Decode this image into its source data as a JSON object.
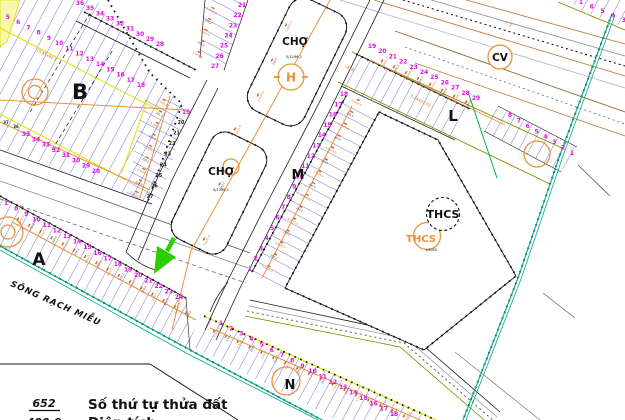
{
  "map": {
    "colors": {
      "magenta": "#E010E0",
      "lot_blue": "#4646C8",
      "orange": "#E8923C",
      "dim_orange": "#D2691E",
      "yellow": "#E2E200",
      "olive": "#8A8A00",
      "teal": "#00AA88",
      "green_boundary": "#00B050",
      "arrow_green": "#2FCC00",
      "tan": "#C08344",
      "black": "#1A1A1A"
    },
    "labels": {
      "block_b": "B",
      "block_a": "A",
      "block_m": "M",
      "block_l": "L",
      "block_n": "N",
      "market_1": "CHỢ",
      "market_1_area": "5/1196.1",
      "market_2": "CHỢ",
      "market_2_area": "4/1396.1",
      "helipad": "H",
      "park": "CV",
      "school": "THCS",
      "school_secondary": "THCS",
      "school_area": "1/4043",
      "river": "SÔNG RẠCH MIỄU",
      "dim_l": "7.24x25.05",
      "dim_l2": "8.06",
      "dim_b": "15.45x80.5",
      "dim_blvd": "7.5"
    },
    "legend": {
      "code": "652",
      "label": "Số thứ tự thửa đất",
      "code2": "400.0",
      "label2": "Diện tích"
    },
    "dim_labels": [
      "5.0x25.0",
      "255.2",
      "5.0x25.0",
      "250.0"
    ],
    "number_rows": [
      {
        "name": "b-inner",
        "color": "#E010E0",
        "size": 6,
        "from": [
          8,
          19
        ],
        "to": [
          141,
          87
        ],
        "labels": [
          "5",
          "6",
          "7",
          "8",
          "9",
          "10",
          "11",
          "12",
          "13",
          "14",
          "15",
          "16",
          "17",
          "18"
        ]
      },
      {
        "name": "b-top",
        "color": "#E010E0",
        "size": 6,
        "from": [
          80,
          5
        ],
        "to": [
          160,
          46
        ],
        "labels": [
          "36",
          "35",
          "34",
          "33",
          "32",
          "31",
          "30",
          "29",
          "28"
        ]
      },
      {
        "name": "b-lower",
        "color": "#E010E0",
        "size": 6,
        "from": [
          26,
          136
        ],
        "to": [
          96,
          173
        ],
        "labels": [
          "35",
          "34",
          "33",
          "32",
          "31",
          "30",
          "29",
          "28"
        ]
      },
      {
        "name": "b-right-black",
        "color": "#222222",
        "size": 4.8,
        "from": [
          181,
          124
        ],
        "to": [
          150,
          198
        ],
        "labels": [
          "20",
          "21",
          "22",
          "23",
          "24",
          "25",
          "26",
          "27"
        ]
      },
      {
        "name": "b-small-black",
        "color": "#222222",
        "size": 4,
        "from": [
          6,
          124
        ],
        "to": [
          16,
          128
        ],
        "labels": [
          "37",
          "36"
        ]
      },
      {
        "name": "b-right-19",
        "color": "#E010E0",
        "size": 6,
        "from": [
          186,
          114
        ],
        "to": [
          186,
          114
        ],
        "labels": [
          "19"
        ]
      },
      {
        "name": "cho-left-col",
        "color": "#E010E0",
        "size": 6,
        "from": [
          242,
          7
        ],
        "to": [
          215,
          68
        ],
        "labels": [
          "21",
          "22",
          "23",
          "24",
          "25",
          "26",
          "27"
        ]
      },
      {
        "name": "m-left",
        "color": "#E010E0",
        "size": 6,
        "from": [
          250,
          271
        ],
        "to": [
          344,
          96
        ],
        "labels": [
          "1",
          "2",
          "3",
          "4",
          "5",
          "6",
          "7",
          "8",
          "9",
          "10",
          "11",
          "12",
          "13",
          "14",
          "15",
          "16",
          "17",
          "18"
        ]
      },
      {
        "name": "l-top",
        "color": "#E010E0",
        "size": 6,
        "from": [
          372,
          48
        ],
        "to": [
          476,
          100
        ],
        "labels": [
          "19",
          "20",
          "21",
          "22",
          "23",
          "24",
          "25",
          "26",
          "27",
          "28",
          "29"
        ]
      },
      {
        "name": "l-right",
        "color": "#E010E0",
        "size": 6,
        "from": [
          510,
          117
        ],
        "to": [
          572,
          155
        ],
        "labels": [
          "8",
          "7",
          "6",
          "5",
          "4",
          "3",
          "2",
          "1"
        ]
      },
      {
        "name": "top-right",
        "color": "#E010E0",
        "size": 6,
        "from": [
          581,
          4
        ],
        "to": [
          624,
          22
        ],
        "labels": [
          "1",
          "6",
          "5",
          "4",
          "3"
        ]
      },
      {
        "name": "a-row",
        "color": "#E010E0",
        "size": 6,
        "from": [
          6,
          205
        ],
        "to": [
          179,
          299
        ],
        "labels": [
          "1",
          "8",
          "9",
          "10",
          "11",
          "12",
          "13",
          "14",
          "15",
          "16",
          "17",
          "18",
          "19",
          "20",
          "21",
          "22",
          "23",
          "24"
        ]
      },
      {
        "name": "n-row",
        "color": "#E010E0",
        "size": 6,
        "from": [
          221,
          325
        ],
        "to": [
          394,
          416
        ],
        "labels": [
          "1",
          "2",
          "3",
          "4",
          "5",
          "6",
          "7",
          "8",
          "9",
          "10",
          "11",
          "12",
          "13",
          "14",
          "15",
          "16",
          "17",
          "18"
        ]
      }
    ],
    "dim_strips": [
      {
        "from": [
          163,
          102
        ],
        "to": [
          136,
          194
        ],
        "n": 9,
        "angle": 28
      },
      {
        "from": [
          268,
          268
        ],
        "to": [
          357,
          102
        ],
        "n": 15,
        "angle": 28
      },
      {
        "from": [
          20,
          220
        ],
        "to": [
          188,
          314
        ],
        "n": 16,
        "angle": -62
      },
      {
        "from": [
          216,
          332
        ],
        "to": [
          406,
          417
        ],
        "n": 17,
        "angle": -62
      },
      {
        "from": [
          212,
          10
        ],
        "to": [
          198,
          54
        ],
        "n": 5,
        "angle": 28
      },
      {
        "from": [
          384,
          62
        ],
        "to": [
          468,
          103
        ],
        "n": 8,
        "angle": -62
      },
      {
        "from": [
          288,
          26
        ],
        "to": [
          260,
          96
        ],
        "n": 3,
        "angle": -64
      },
      {
        "from": [
          237,
          130
        ],
        "to": [
          206,
          240
        ],
        "n": 3,
        "angle": -64
      }
    ]
  }
}
